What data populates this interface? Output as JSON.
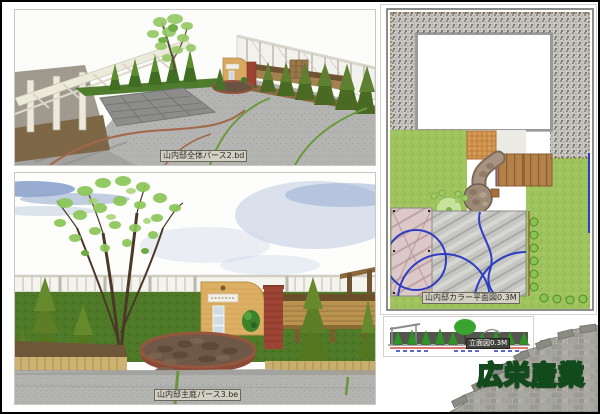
{
  "board": {
    "company_label": "広栄産業",
    "colors": {
      "company_green": "#3df25c",
      "company_outline": "#134a1c",
      "board_border": "#000000",
      "lawn_green": "#9fc45e",
      "paving_gray": "#b3b3b1",
      "brick_tan": "#dcaf62",
      "brick_red": "#9e4434",
      "plan_blue_line": "#2e3ec2"
    }
  },
  "panels": {
    "perspective_overall": {
      "caption": "山内邸全体パース2.bd"
    },
    "perspective_main_garden": {
      "caption": "山内邸主庭パース3.be"
    },
    "color_plan": {
      "caption": "山内邸カラー平面図0.3M"
    },
    "elevation": {
      "caption": "立面図0.3M"
    }
  }
}
